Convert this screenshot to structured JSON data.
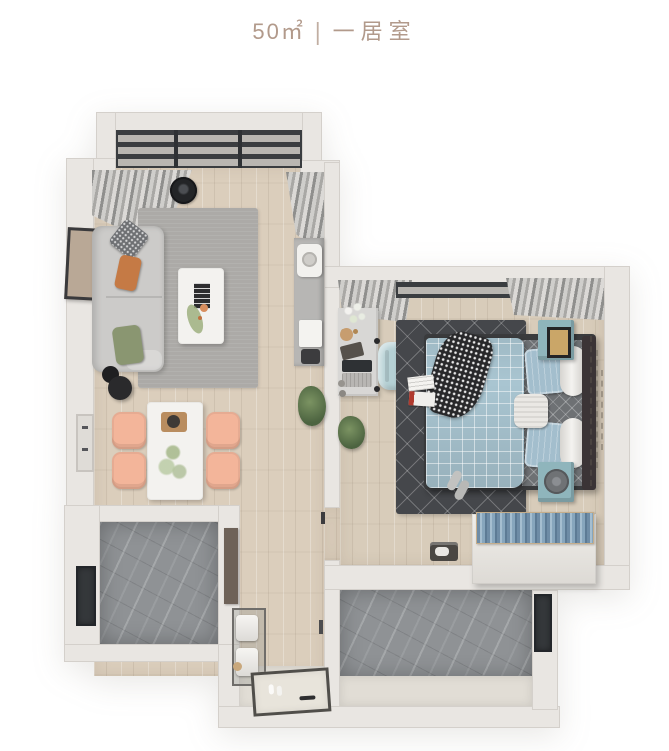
{
  "header": {
    "area": "50㎡",
    "separator": "|",
    "room_type": "一居室"
  },
  "palette": {
    "title": "#b29a8b",
    "wall": "#e9e6e2",
    "wall_edge": "#d4d0cb",
    "wood_living": "#dbcebc",
    "wood_bedroom": "#d8ccba",
    "marble": "#8f9295",
    "concrete": "#e1ddd5",
    "rug_living": "#acaaa7",
    "rug_bedroom": "#45474b",
    "sofa": "#cccbc9",
    "chair_peach": "#f3b59a",
    "nightstand_teal": "#8fb5bc",
    "duvet_blue": "#a9c5d1",
    "chair_mint": "#b5d0d4"
  }
}
